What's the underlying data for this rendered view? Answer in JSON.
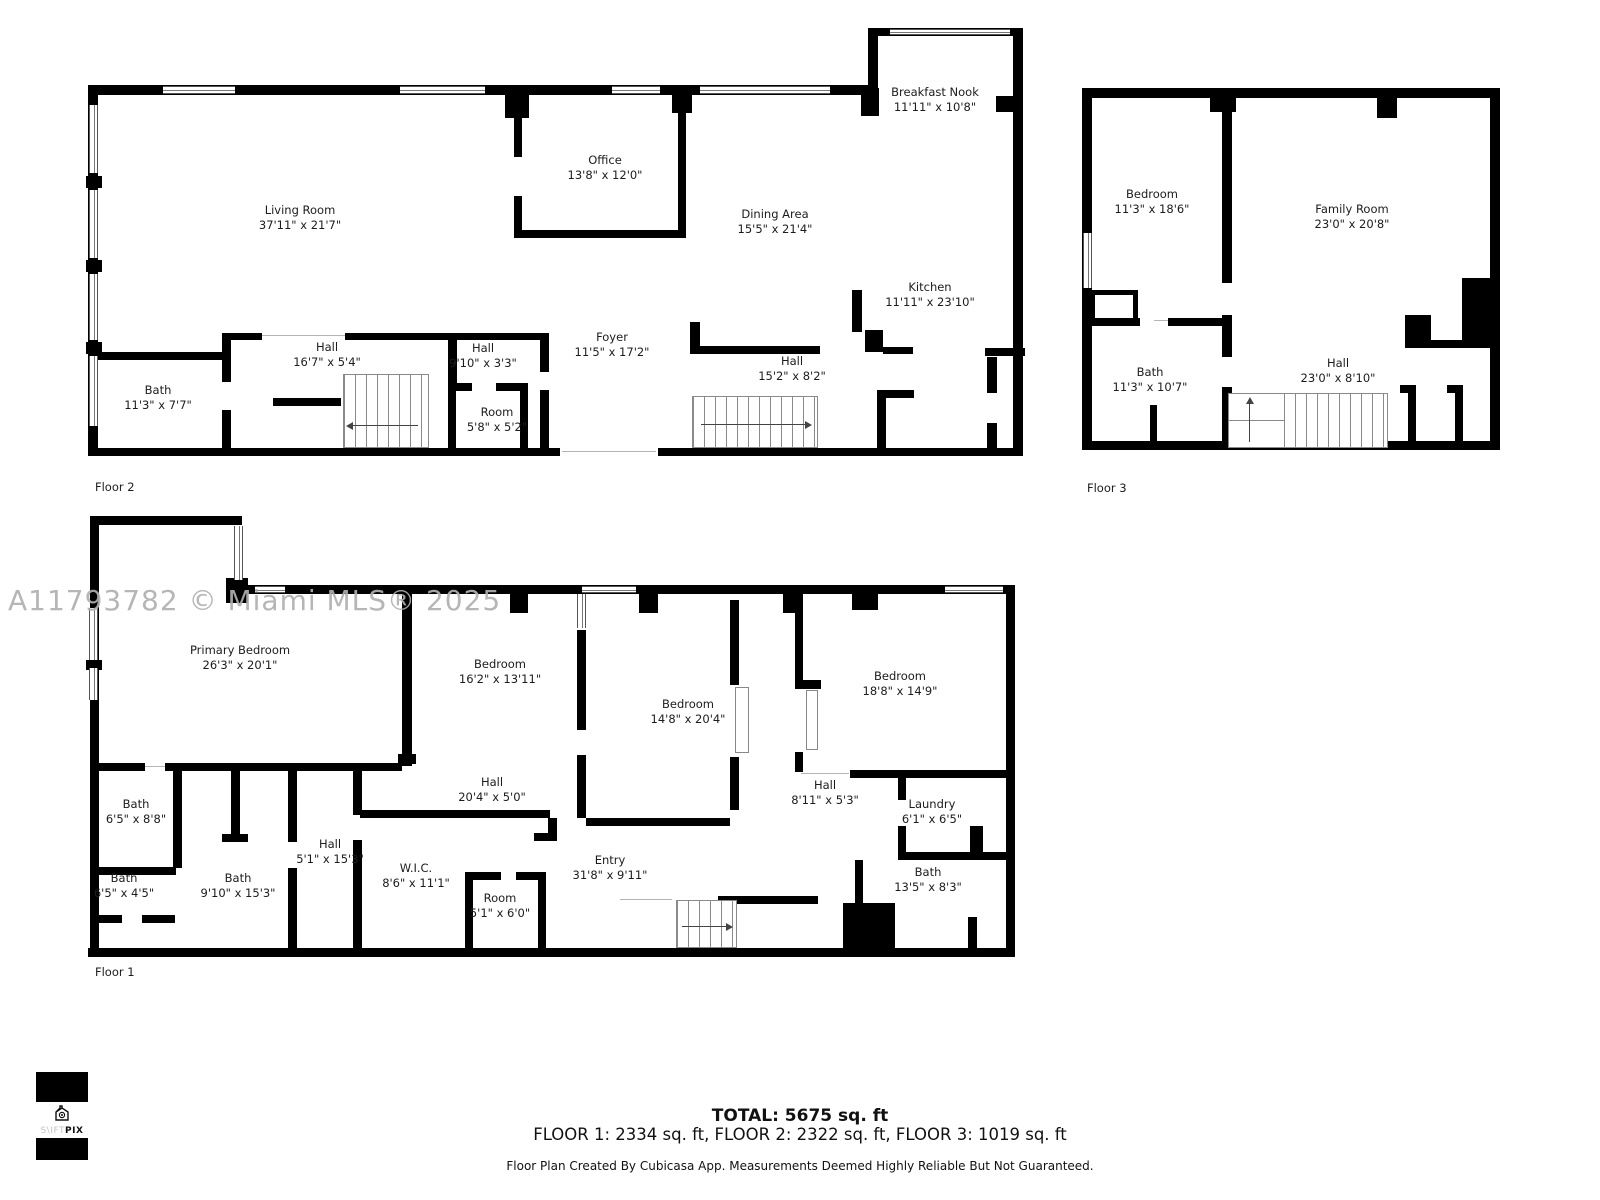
{
  "watermark": "A11793782 © Miami MLS® 2025",
  "logo": {
    "brand_light": "S\\IFT",
    "brand_bold": "PIX"
  },
  "floors": {
    "floor2": {
      "label": "Floor 2",
      "rooms": {
        "living_room": {
          "name": "Living Room",
          "dims": "37'11\" x 21'7\""
        },
        "office": {
          "name": "Office",
          "dims": "13'8\" x 12'0\""
        },
        "breakfast_nook": {
          "name": "Breakfast Nook",
          "dims": "11'11\" x 10'8\""
        },
        "dining_area": {
          "name": "Dining Area",
          "dims": "15'5\" x 21'4\""
        },
        "kitchen": {
          "name": "Kitchen",
          "dims": "11'11\" x 23'10\""
        },
        "foyer": {
          "name": "Foyer",
          "dims": "11'5\" x 17'2\""
        },
        "hall_a": {
          "name": "Hall",
          "dims": "16'7\" x 5'4\""
        },
        "hall_b": {
          "name": "Hall",
          "dims": "9'10\" x 3'3\""
        },
        "hall_c": {
          "name": "Hall",
          "dims": "15'2\" x 8'2\""
        },
        "bath": {
          "name": "Bath",
          "dims": "11'3\" x 7'7\""
        },
        "room": {
          "name": "Room",
          "dims": "5'8\" x 5'2\""
        }
      }
    },
    "floor3": {
      "label": "Floor 3",
      "rooms": {
        "bedroom": {
          "name": "Bedroom",
          "dims": "11'3\" x 18'6\""
        },
        "family_room": {
          "name": "Family Room",
          "dims": "23'0\" x 20'8\""
        },
        "bath": {
          "name": "Bath",
          "dims": "11'3\" x 10'7\""
        },
        "hall": {
          "name": "Hall",
          "dims": "23'0\" x 8'10\""
        }
      }
    },
    "floor1": {
      "label": "Floor 1",
      "rooms": {
        "primary_bedroom": {
          "name": "Primary Bedroom",
          "dims": "26'3\" x 20'1\""
        },
        "bedroom_a": {
          "name": "Bedroom",
          "dims": "16'2\" x 13'11\""
        },
        "bedroom_b": {
          "name": "Bedroom",
          "dims": "14'8\" x 20'4\""
        },
        "bedroom_c": {
          "name": "Bedroom",
          "dims": "18'8\" x 14'9\""
        },
        "hall_a": {
          "name": "Hall",
          "dims": "20'4\" x 5'0\""
        },
        "hall_b": {
          "name": "Hall",
          "dims": "8'11\" x 5'3\""
        },
        "laundry": {
          "name": "Laundry",
          "dims": "6'1\" x 6'5\""
        },
        "bath_a": {
          "name": "Bath",
          "dims": "6'5\" x 8'8\""
        },
        "bath_b": {
          "name": "Bath",
          "dims": "6'5\" x 4'5\""
        },
        "bath_c": {
          "name": "Bath",
          "dims": "9'10\" x 15'3\""
        },
        "hall_c": {
          "name": "Hall",
          "dims": "5'1\" x 15'3\""
        },
        "wic": {
          "name": "W.I.C.",
          "dims": "8'6\" x 11'1\""
        },
        "room": {
          "name": "Room",
          "dims": "5'1\" x 6'0\""
        },
        "entry": {
          "name": "Entry",
          "dims": "31'8\" x 9'11\""
        },
        "bath_d": {
          "name": "Bath",
          "dims": "13'5\" x 8'3\""
        }
      }
    }
  },
  "summary": {
    "total": "TOTAL: 5675 sq. ft",
    "floor_breakdown": "FLOOR 1: 2334 sq. ft, FLOOR 2: 2322 sq. ft, FLOOR 3: 1019 sq. ft",
    "disclaimer": "Floor Plan Created By Cubicasa App. Measurements Deemed Highly Reliable But Not Guaranteed."
  }
}
